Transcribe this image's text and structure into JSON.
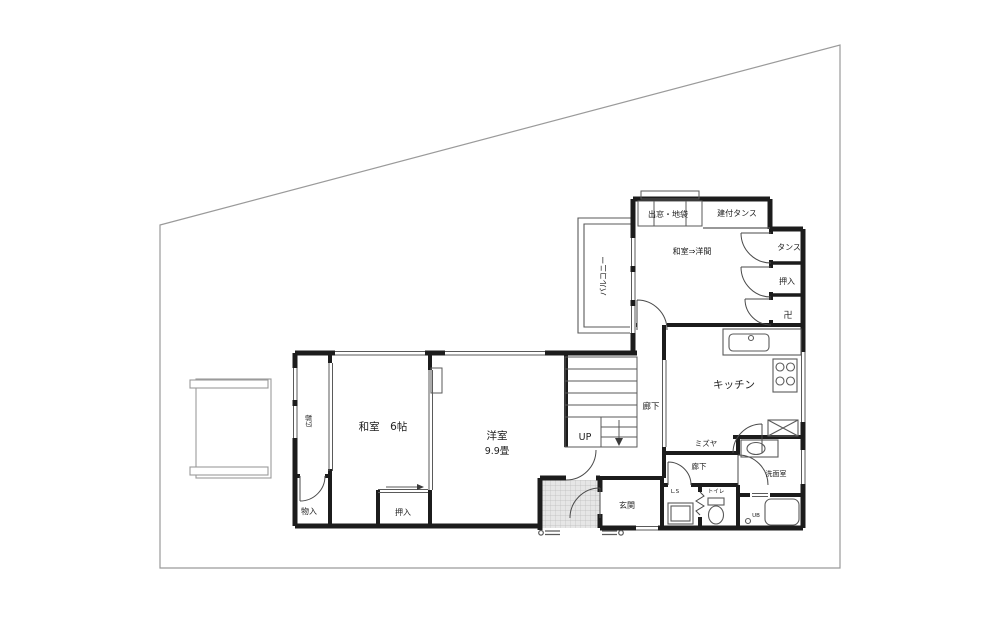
{
  "colors": {
    "wall": "#1c1c1c",
    "line": "#5a5a5a",
    "boundary": "#9a9a9a",
    "door": "#4a4a4a",
    "hatch_bg": "#e6e6e6",
    "hatch_line": "#bcbcbc",
    "text": "#222222"
  },
  "rooms": {
    "converted_room": "和室⇒洋間",
    "bay_window": "出窓・地袋",
    "built_in_tansu": "建付タンス",
    "tansu": "タンス",
    "closet_upper": "押入",
    "butsudan": "卍",
    "balcony": "バルコニー",
    "kitchen": "キッチン",
    "mizuya": "ミズヤ",
    "hallway_main": "廊下",
    "hallway_rear": "廊下",
    "washroom": "洗面室",
    "stairs_up": "UP",
    "japanese_room": "和室　6帖",
    "western_room": "洋室",
    "western_room_size": "9.9畳",
    "engawa": "広縁",
    "storage": "物入",
    "closet_lower": "押入",
    "entrance": "玄関",
    "linen_storage": "L.S",
    "toilet": "トイレ",
    "unit_bath": "UB"
  }
}
